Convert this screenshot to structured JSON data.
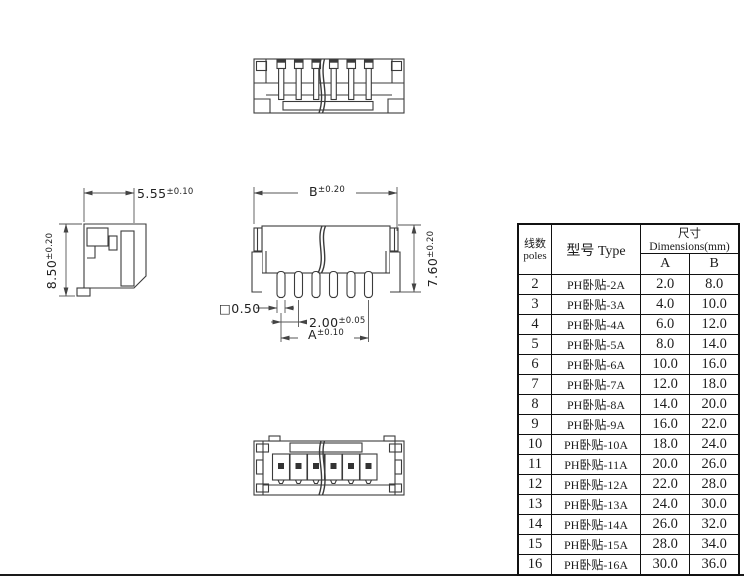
{
  "drawing": {
    "dim_side_width": {
      "value": "5.55",
      "tol": "±0.10"
    },
    "dim_side_height": {
      "value": "8.50",
      "tol": "±0.20"
    },
    "dim_front_width": {
      "value": "B",
      "tol": "±0.20"
    },
    "dim_front_height": {
      "value": "7.60",
      "tol": "±0.20"
    },
    "dim_pin_size": {
      "value": "□0.50",
      "tol": ""
    },
    "dim_pin_pitch": {
      "value": "2.00",
      "tol": "±0.05"
    },
    "dim_pin_span": {
      "value": "A",
      "tol": "±0.10"
    }
  },
  "table": {
    "header": {
      "poles_zh": "线数",
      "poles_en": "poles",
      "type": "型号 Type",
      "dimensions": "尺寸 Dimensions(mm)",
      "col_a": "A",
      "col_b": "B"
    },
    "rows": [
      {
        "poles": "2",
        "type": "PH卧贴-2A",
        "a": "2.0",
        "b": "8.0"
      },
      {
        "poles": "3",
        "type": "PH卧贴-3A",
        "a": "4.0",
        "b": "10.0"
      },
      {
        "poles": "4",
        "type": "PH卧贴-4A",
        "a": "6.0",
        "b": "12.0"
      },
      {
        "poles": "5",
        "type": "PH卧贴-5A",
        "a": "8.0",
        "b": "14.0"
      },
      {
        "poles": "6",
        "type": "PH卧贴-6A",
        "a": "10.0",
        "b": "16.0"
      },
      {
        "poles": "7",
        "type": "PH卧贴-7A",
        "a": "12.0",
        "b": "18.0"
      },
      {
        "poles": "8",
        "type": "PH卧贴-8A",
        "a": "14.0",
        "b": "20.0"
      },
      {
        "poles": "9",
        "type": "PH卧贴-9A",
        "a": "16.0",
        "b": "22.0"
      },
      {
        "poles": "10",
        "type": "PH卧贴-10A",
        "a": "18.0",
        "b": "24.0"
      },
      {
        "poles": "11",
        "type": "PH卧贴-11A",
        "a": "20.0",
        "b": "26.0"
      },
      {
        "poles": "12",
        "type": "PH卧贴-12A",
        "a": "22.0",
        "b": "28.0"
      },
      {
        "poles": "13",
        "type": "PH卧贴-13A",
        "a": "24.0",
        "b": "30.0"
      },
      {
        "poles": "14",
        "type": "PH卧贴-14A",
        "a": "26.0",
        "b": "32.0"
      },
      {
        "poles": "15",
        "type": "PH卧贴-15A",
        "a": "28.0",
        "b": "34.0"
      },
      {
        "poles": "16",
        "type": "PH卧贴-16A",
        "a": "30.0",
        "b": "36.0"
      }
    ]
  }
}
